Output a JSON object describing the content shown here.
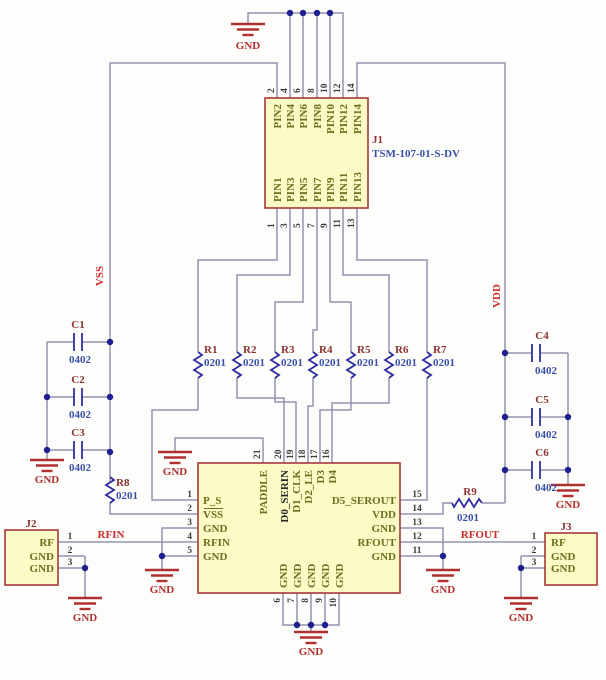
{
  "schematic": {
    "gnd": "GND",
    "nets": {
      "vss": "VSS",
      "vdd": "VDD",
      "rfin": "RFIN",
      "rfout": "RFOUT"
    },
    "j1": {
      "ref": "J1",
      "part": "TSM-107-01-S-DV",
      "top_nums": [
        "2",
        "4",
        "6",
        "8",
        "10",
        "12",
        "14"
      ],
      "top_names": [
        "PIN2",
        "PIN4",
        "PIN6",
        "PIN8",
        "PIN10",
        "PIN12",
        "PIN14"
      ],
      "bot_nums": [
        "1",
        "3",
        "5",
        "7",
        "9",
        "11",
        "13"
      ],
      "bot_names": [
        "PIN1",
        "PIN3",
        "PIN5",
        "PIN7",
        "PIN9",
        "PIN11",
        "PIN13"
      ]
    },
    "resistors": [
      {
        "ref": "R1",
        "val": "0201"
      },
      {
        "ref": "R2",
        "val": "0201"
      },
      {
        "ref": "R3",
        "val": "0201"
      },
      {
        "ref": "R4",
        "val": "0201"
      },
      {
        "ref": "R5",
        "val": "0201"
      },
      {
        "ref": "R6",
        "val": "0201"
      },
      {
        "ref": "R7",
        "val": "0201"
      },
      {
        "ref": "R8",
        "val": "0201"
      },
      {
        "ref": "R9",
        "val": "0201"
      }
    ],
    "caps": [
      {
        "ref": "C1",
        "val": "0402"
      },
      {
        "ref": "C2",
        "val": "0402"
      },
      {
        "ref": "C3",
        "val": "0402"
      },
      {
        "ref": "C4",
        "val": "0402"
      },
      {
        "ref": "C5",
        "val": "0402"
      },
      {
        "ref": "C6",
        "val": "0402"
      }
    ],
    "ic": {
      "left_nums": [
        "1",
        "2",
        "3",
        "4",
        "5"
      ],
      "left_names": [
        "P_S",
        "VSS",
        "GND",
        "RFIN",
        "GND"
      ],
      "right_nums": [
        "15",
        "14",
        "13",
        "12",
        "11"
      ],
      "right_names": [
        "D5_SEROUT",
        "VDD",
        "GND",
        "RFOUT",
        "GND"
      ],
      "top_nums": [
        "21",
        "20",
        "19",
        "18",
        "17",
        "16"
      ],
      "top_names": [
        "PADDLE",
        "D0_SERIN",
        "D1_CLK",
        "D2_LE",
        "D3",
        "D4"
      ],
      "bot_nums": [
        "6",
        "7",
        "8",
        "9",
        "10"
      ],
      "bot_names": [
        "GND",
        "GND",
        "GND",
        "GND",
        "GND"
      ]
    },
    "j2": {
      "ref": "J2",
      "nums": [
        "1",
        "2",
        "3"
      ],
      "names": [
        "RF",
        "GND",
        "GND"
      ]
    },
    "j3": {
      "ref": "J3",
      "nums": [
        "1",
        "2",
        "3"
      ],
      "names": [
        "RF",
        "GND",
        "GND"
      ]
    },
    "colors": {
      "wire": "#9494b0",
      "symbol": "#2e2e9e",
      "body_fill": "#fcfac5",
      "body_stroke": "#a83838",
      "net_label": "#cc2a2a",
      "gnd": "#b03030",
      "refdes": "#8b3232",
      "value": "#3a50a8",
      "pin_name": "#6e6e1e"
    }
  }
}
